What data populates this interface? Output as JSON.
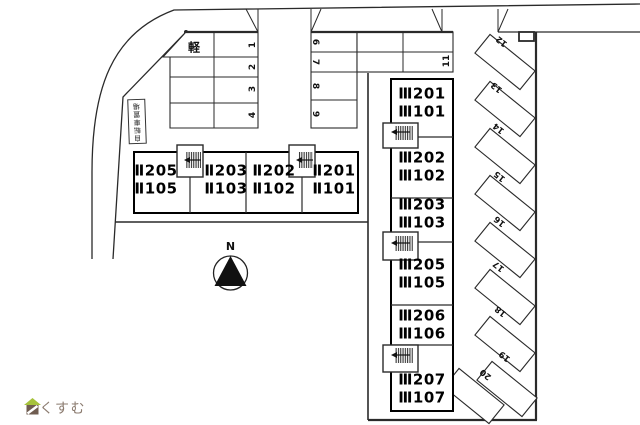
{
  "buildings": {
    "b2": {
      "units": [
        {
          "top": "Ⅱ205",
          "bottom": "Ⅱ105"
        },
        {
          "top": "Ⅱ203",
          "bottom": "Ⅱ103"
        },
        {
          "top": "Ⅱ202",
          "bottom": "Ⅱ102"
        },
        {
          "top": "Ⅱ201",
          "bottom": "Ⅱ101"
        }
      ]
    },
    "b3": {
      "units": [
        {
          "top": "Ⅲ201",
          "bottom": "Ⅲ101"
        },
        {
          "top": "Ⅲ202",
          "bottom": "Ⅲ102"
        },
        {
          "top": "Ⅲ203",
          "bottom": "Ⅲ103"
        },
        {
          "top": "Ⅲ205",
          "bottom": "Ⅲ105"
        },
        {
          "top": "Ⅲ206",
          "bottom": "Ⅲ106"
        },
        {
          "top": "Ⅲ207",
          "bottom": "Ⅲ107"
        }
      ]
    }
  },
  "parking": {
    "kei": "軽",
    "row_a": [
      "1",
      "2",
      "3",
      "4"
    ],
    "row_b": [
      "6",
      "7",
      "8",
      "9"
    ],
    "single": "11",
    "diagonal": [
      "12",
      "13",
      "14",
      "15",
      "16",
      "17",
      "18",
      "19",
      "20"
    ]
  },
  "labels": {
    "bicycle": "自転車置場",
    "compass": "N",
    "logo": "らくすむ"
  },
  "colors": {
    "line": "#2a2a2a",
    "logo_text": "#8b7b6f",
    "logo_roof": "#a6c23c",
    "logo_body": "#6f5c50"
  }
}
